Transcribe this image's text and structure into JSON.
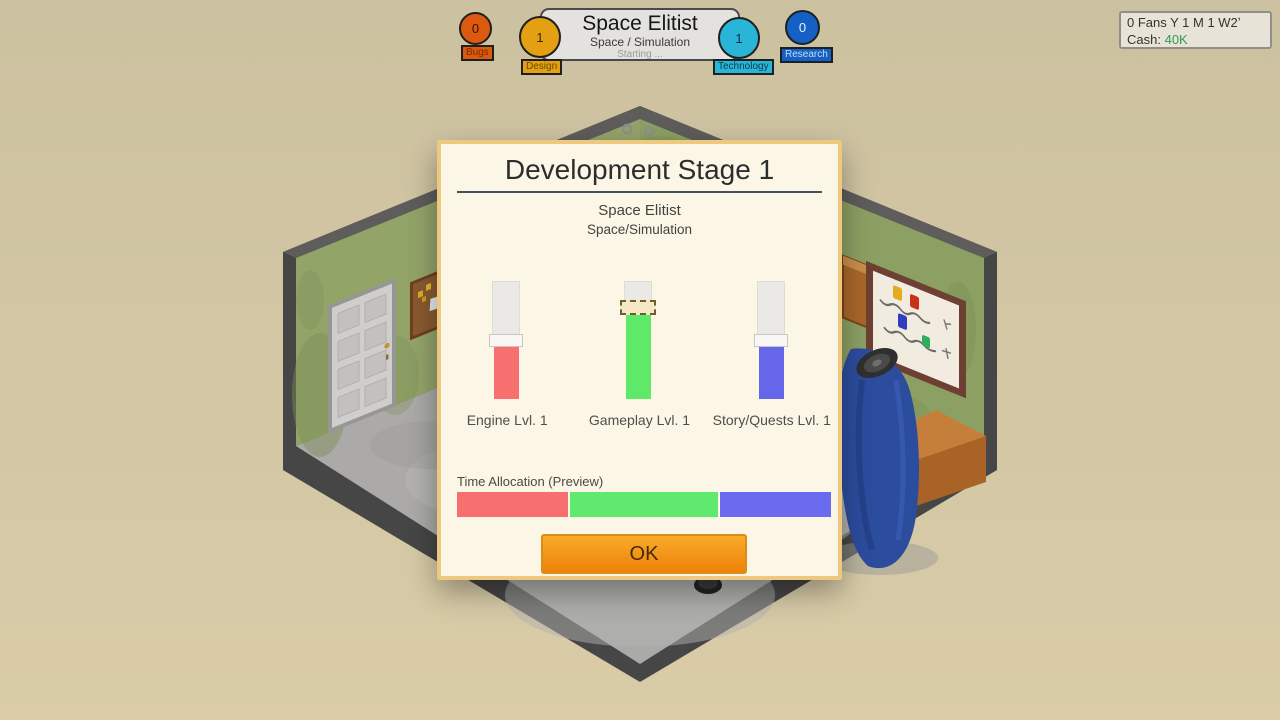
{
  "header": {
    "game_title": "Space Elitist",
    "game_genre": "Space / Simulation",
    "status": "Starting ...",
    "badges": {
      "bugs": {
        "count": "0",
        "label": "Bugs",
        "color": "#DC5A10"
      },
      "design": {
        "count": "1",
        "label": "Design",
        "color": "#E2A012"
      },
      "technology": {
        "count": "1",
        "label": "Technology",
        "color": "#28B5D8"
      },
      "research": {
        "count": "0",
        "label": "Research",
        "color": "#1460C4"
      }
    }
  },
  "hud": {
    "fans_date_line": "0 Fans Y 1 M 1 W2ʼ",
    "cash_label": "Cash:",
    "cash_value": "40K",
    "cash_color": "#2F9A55"
  },
  "dialog": {
    "title": "Development Stage 1",
    "game_name": "Space Elitist",
    "game_genre": "Space/Simulation",
    "sliders": [
      {
        "name": "engine",
        "label": "Engine Lvl. 1",
        "color": "#F76F6F",
        "fill_pct": 44,
        "active": false
      },
      {
        "name": "gameplay",
        "label": "Gameplay Lvl. 1",
        "color": "#5FE969",
        "fill_pct": 71,
        "active": true
      },
      {
        "name": "story",
        "label": "Story/Quests Lvl. 1",
        "color": "#6666EB",
        "fill_pct": 44,
        "active": false
      }
    ],
    "time_allocation": {
      "label": "Time Allocation (Preview)",
      "segments": [
        {
          "name": "engine",
          "color": "#F76F6F",
          "pct": 30
        },
        {
          "name": "gameplay",
          "color": "#5FE96E",
          "pct": 40
        },
        {
          "name": "story",
          "color": "#6B6BEF",
          "pct": 30
        }
      ]
    },
    "ok_label": "OK"
  }
}
